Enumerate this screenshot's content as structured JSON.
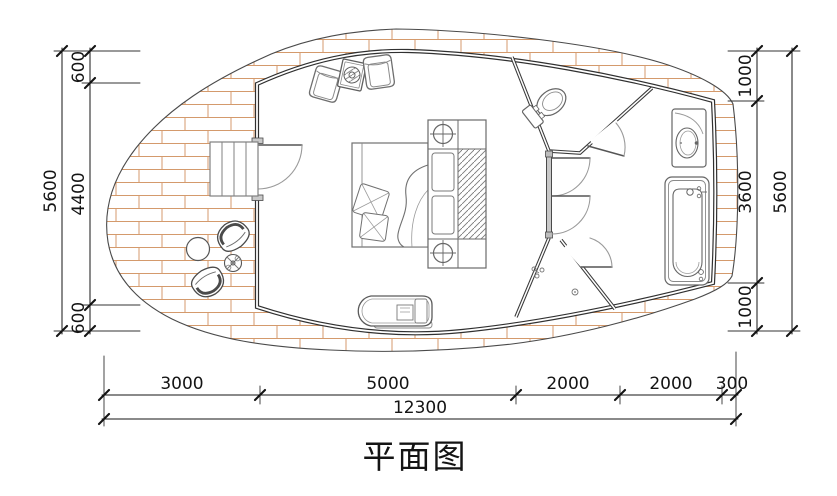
{
  "title": "平面图",
  "dimensions": {
    "left": {
      "overall": "5600",
      "segments": [
        "600",
        "4400",
        "600"
      ]
    },
    "right": {
      "overall": "5600",
      "segments": [
        "1000",
        "3600",
        "1000"
      ]
    },
    "bottom": {
      "overall": "12300",
      "segments": [
        "3000",
        "5000",
        "2000",
        "2000",
        "300"
      ]
    }
  },
  "colors": {
    "wall": "#303030",
    "interior_wall": "#4a4a4a",
    "brick": "#d49a6c",
    "dimension": "#141414",
    "furniture": "#6e6e6e",
    "deck_edge": "#4a4a4a"
  }
}
